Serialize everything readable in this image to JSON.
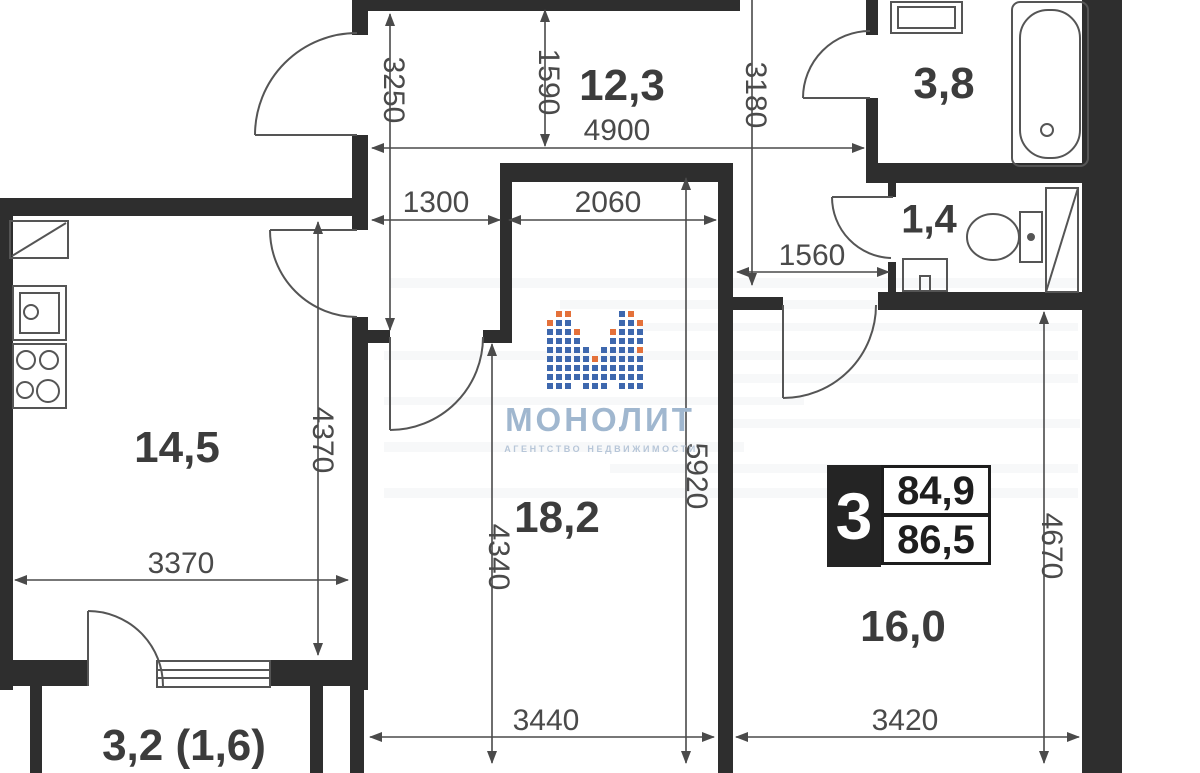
{
  "logo": {
    "brand": "МОНОЛИТ",
    "tagline": "АГЕНТСТВО НЕДВИЖИМОСТИ"
  },
  "badge": {
    "rooms": "3",
    "area_top": "84,9",
    "area_bottom": "86,5"
  },
  "rooms": [
    {
      "id": "hallway",
      "label": "12,3"
    },
    {
      "id": "bathroom",
      "label": "3,8"
    },
    {
      "id": "wc",
      "label": "1,4"
    },
    {
      "id": "kitchen",
      "label": "14,5"
    },
    {
      "id": "living",
      "label": "18,2"
    },
    {
      "id": "bedroom",
      "label": "16,0"
    },
    {
      "id": "balcony",
      "label": "3,2 (1,6)"
    }
  ],
  "dims": [
    {
      "id": "dim-3250",
      "value": "3250",
      "orientation": "vertical"
    },
    {
      "id": "dim-1590",
      "value": "1590",
      "orientation": "vertical"
    },
    {
      "id": "dim-3180",
      "value": "3180",
      "orientation": "vertical"
    },
    {
      "id": "dim-4900",
      "value": "4900",
      "orientation": "horizontal"
    },
    {
      "id": "dim-1300",
      "value": "1300",
      "orientation": "horizontal"
    },
    {
      "id": "dim-2060",
      "value": "2060",
      "orientation": "horizontal"
    },
    {
      "id": "dim-1560",
      "value": "1560",
      "orientation": "horizontal"
    },
    {
      "id": "dim-4370",
      "value": "4370",
      "orientation": "vertical"
    },
    {
      "id": "dim-3370",
      "value": "3370",
      "orientation": "horizontal"
    },
    {
      "id": "dim-4340",
      "value": "4340",
      "orientation": "vertical"
    },
    {
      "id": "dim-5920",
      "value": "5920",
      "orientation": "vertical"
    },
    {
      "id": "dim-4670",
      "value": "4670",
      "orientation": "vertical"
    },
    {
      "id": "dim-3440",
      "value": "3440",
      "orientation": "horizontal"
    },
    {
      "id": "dim-3420",
      "value": "3420",
      "orientation": "horizontal"
    }
  ],
  "colors": {
    "wall": "#2e2e2e",
    "line": "#555555",
    "label": "#3c3c3c",
    "logo_blue": "#a0b7cf",
    "tile_blue": "#3e68ae",
    "tile_orange": "#e4713a",
    "badge_black": "#242424"
  }
}
